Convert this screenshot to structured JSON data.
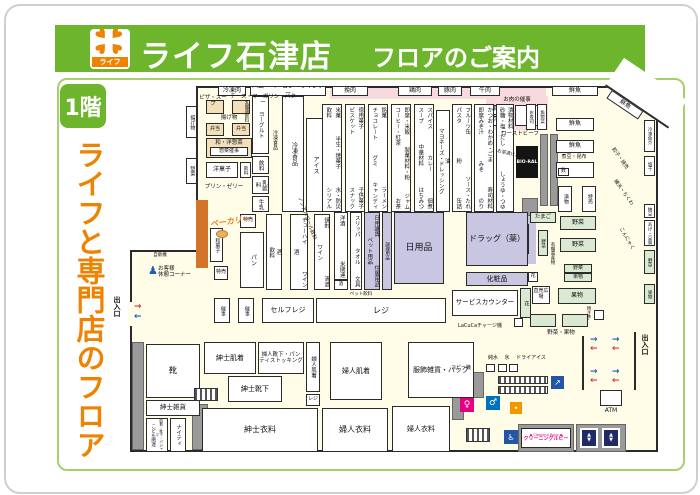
{
  "header": {
    "store_name": "ライフ石津店",
    "guide": "フロアのご案内",
    "logo_name": "ライフ"
  },
  "sidebar": {
    "floor_badge": "1階",
    "tagline": "ライフと専門店のフロア"
  },
  "walls": {
    "top": [
      "冷凍肉",
      "ハム・ベーコン・ウインナー",
      "挽肉",
      "鶏肉",
      "豚肉",
      "牛肉",
      "鮮魚",
      "鮮魚"
    ],
    "left_deli": [
      "揚げ物",
      "惣菜"
    ],
    "right": [
      "冷凍魚介",
      "塩干",
      "納豆",
      "あげ・豆腐",
      "野菜",
      "果物"
    ],
    "right_notes": [
      "餃子・焼売",
      "練天・ちくわ",
      "こんにゃく"
    ]
  },
  "meat_event": {
    "title": "お肉の催事",
    "box1": "銘柄豚",
    "box2": "冷凍肉",
    "roast": "ローストビーフ"
  },
  "deli": {
    "pizza_soup": "ピザ・スープ",
    "cheese": "チーズ・マーガリン・バター",
    "fried": "揚げ物",
    "bento": "弁当",
    "bento2": "弁当",
    "wayo": "和・洋惣菜",
    "event": "惣菜催事",
    "yogashi": "洋菓子",
    "drink": "飲料",
    "pudding": "プリン・ゼリー",
    "bakery": "ベーカリー"
  },
  "dairy": {
    "yogurt": "ヨーグルト",
    "lactic": "乳酸菌飲料",
    "drink": "飲料",
    "milk_drink": "乳飲料",
    "milk": "牛乳",
    "frozen_face": "冷凍食品",
    "frozen": "冷凍食品",
    "ice": "アイス"
  },
  "aisles": [
    {
      "left": [
        "飲料",
        "シリアル"
      ],
      "right": [
        "米菓",
        "半生・焼菓子",
        "水・防災"
      ]
    },
    {
      "left": [
        "ビスケット",
        "スナック"
      ],
      "right": [
        "徳用菓子",
        "子供菓子"
      ]
    },
    {
      "left": [
        "チョコレート",
        "グミ",
        "キャンディ"
      ],
      "right": [
        "銘菓",
        "ラーメン"
      ]
    },
    {
      "left": [
        "コーヒー・紅茶",
        "お茶"
      ],
      "right": [
        "即席・米飯",
        "製菓材料・粉",
        "ジャム"
      ]
    },
    {
      "left": [
        "スープ",
        "中華材料",
        "はちみつ"
      ],
      "right": [
        "スパイス",
        "カレー",
        "佃煮"
      ]
    },
    {
      "left": [
        "マヨネーズ・ドレッシング"
      ],
      "right": [
        "油"
      ]
    },
    {
      "left": [
        "パスタ",
        "粉",
        "缶詰"
      ],
      "right": [
        "フルーツ缶",
        "ソース・たれ"
      ]
    },
    {
      "left": [
        "即席みそ汁",
        "みそ",
        "のり"
      ],
      "right": [
        "かつお・わかめ・ごま",
        "寿司材料"
      ]
    },
    {
      "left": [
        "砂糖・塩・だし",
        "しょうゆ・つゆ"
      ],
      "right": [
        "漬物材料"
      ]
    }
  ],
  "aisle_note": "お茶漬けふりかけ",
  "bioral": {
    "name": "BIO-RAL"
  },
  "fish": {
    "sushi": "お寿司",
    "sozai": "魚惣菜",
    "case1": "鮮魚",
    "case2": "鮮魚",
    "nimame": "煮豆・昆布",
    "fu": "麩",
    "tsukemono": "漬物",
    "tokubai": "特売"
  },
  "produce": {
    "egg": "たまご",
    "register": "レジ",
    "veg1": "野菜",
    "veg2": "野菜",
    "veg_s": "野菜",
    "organic": "有機農産物",
    "veg3": "野菜",
    "fruit_s": "果物",
    "fruit": "果物",
    "chokubai": "直売広場",
    "veg_fruit": "野菜・果物",
    "yakiimo": "焼き芋",
    "flower_s": "花"
  },
  "liquor": {
    "col1_left": [
      "飲料"
    ],
    "col1_right": [
      "酒"
    ],
    "col2_left": [
      "酒"
    ],
    "col2_right": [
      "チューハイ",
      "ワイン"
    ],
    "col2_note": "ノンアルコール飲料",
    "col3_left": [
      "ワイン"
    ],
    "col3_right": [
      "焼酎",
      "清酒"
    ],
    "col4": [
      "洋酒",
      "米関連"
    ],
    "col4_small": "酒"
  },
  "bread": {
    "pan": "パン",
    "tokubai1": "特売",
    "tokubai2": "特売",
    "wagashi": "和菓子",
    "saiji1": "催事",
    "saiji2": "催事"
  },
  "daily": {
    "slippers": [
      "スリッパ",
      "タオル",
      "文具"
    ],
    "pet_note": "ペット飲料",
    "pet_list": [
      "ペット用品"
    ],
    "pet_right": [
      "日用雑貨",
      "住居用品"
    ],
    "cooking": "調理用品",
    "nichiyohin": "日用品",
    "drug": "ドラッグ（薬）",
    "cosme": "化粧品"
  },
  "checkout": {
    "self": "セルフレジ",
    "register": "レジ"
  },
  "service": {
    "counter": "サービスカウンター",
    "flower": "花",
    "lacuca": "LaCuCaチャージ機",
    "rest1": "お客様",
    "rest2": "休憩コーナー",
    "vending": "自販機"
  },
  "apparel": {
    "shoes": "靴",
    "mens_goods": "紳士雑貨",
    "kids": "こども関連",
    "kids_sub": "肌着・靴下・パジャマ",
    "nighty": "ナイティ",
    "mens_inner": "紳士肌着",
    "ladies_socks": "婦人靴下・パンティストッキング",
    "mens_socks": "紳士靴下",
    "ladies_inner_s": "婦人肌着",
    "inner_reg": "レジ",
    "ladies_inner": "婦人肌着",
    "mens_wear": "紳士衣料",
    "ladies_wear": "婦人衣料",
    "ladies_wear2": "婦人衣料",
    "accessories": "服飾雑貨・バッグ"
  },
  "facilities": {
    "copy": "コピー機",
    "water": "純水",
    "ice": "氷",
    "dryice": "ドライアイス",
    "atm": "ATM",
    "cleaning_en": "◆ Cleaning Ruby ◆",
    "cleaning": "クリーニングルビー",
    "entrance_left": "出入口",
    "entrance_right": "出入口"
  }
}
